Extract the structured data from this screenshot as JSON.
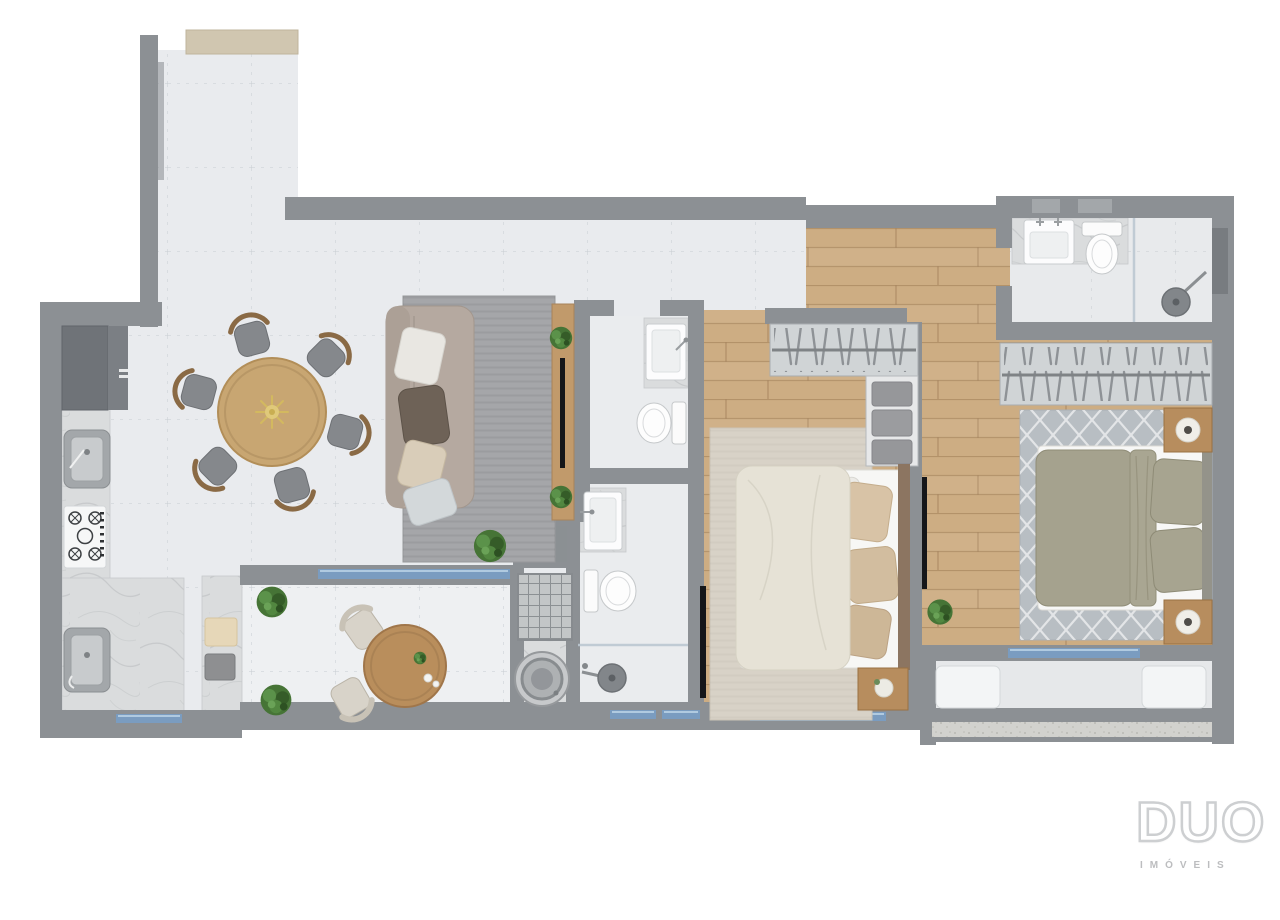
{
  "meta": {
    "title": "Apartment floor plan — top-down render"
  },
  "logo": {
    "title": "DUO",
    "subtitle": "IMÓVEIS"
  },
  "palette": {
    "background": "#ffffff",
    "wall": "#8c9094",
    "tile_floor": "#e9ebee",
    "wood_floor": "#cdad83",
    "marble": "#dadcdd",
    "glass": "#7a9cc0",
    "rug_living": "#a5a6a9",
    "rug_bedroom1": "#d8d2c7",
    "rug_bedroom2": "#b8bec3",
    "sofa": "#b5a9a0",
    "dining_table_wood": "#c8a672",
    "balcony_table_wood": "#b98e5c",
    "blanket_cream": "#e6e2d6",
    "blanket_olive": "#a5a28e",
    "nightstand_wood": "#b78d5e",
    "fixture_white": "#f9fafa",
    "plant_green": "#467436",
    "tv_black": "#151619",
    "logo_gray": "#cdcfd1"
  },
  "plan": {
    "rooms": [
      {
        "id": "entry-hall",
        "furniture": [
          "entry-door-sill"
        ]
      },
      {
        "id": "kitchen",
        "furniture": [
          "refrigerator-cabinet",
          "marble-counter",
          "steel-sink",
          "cooktop"
        ]
      },
      {
        "id": "dining-area",
        "furniture": [
          "round-dining-table",
          "dining-chairs-x6",
          "gold-centerpiece"
        ]
      },
      {
        "id": "living-room",
        "furniture": [
          "sofa",
          "pillows-x4",
          "area-rug",
          "tv-panel",
          "wall-tv",
          "plants"
        ]
      },
      {
        "id": "balcony",
        "furniture": [
          "bistro-table",
          "balcony-chairs-x2",
          "potted-plants-x2",
          "towel-counter",
          "sliding-glass-door"
        ]
      },
      {
        "id": "laundry-area",
        "furniture": [
          "laundry-sink",
          "washing-machine",
          "towels",
          "vent-grate"
        ]
      },
      {
        "id": "bathroom-1",
        "furniture": [
          "vanity-sink",
          "toilet"
        ]
      },
      {
        "id": "bathroom-2",
        "furniture": [
          "vanity-sink",
          "toilet",
          "rain-shower"
        ]
      },
      {
        "id": "hallway",
        "furniture": []
      },
      {
        "id": "bedroom-1",
        "furniture": [
          "double-bed",
          "cream-blanket",
          "pillows",
          "wardrobe-hangers",
          "shelf-clothes",
          "nightstand",
          "area-rug",
          "wall-tv"
        ]
      },
      {
        "id": "bedroom-2",
        "furniture": [
          "double-bed",
          "olive-blanket",
          "pillows-x2",
          "wardrobe-hangers",
          "nightstands-x2",
          "round-lamps-x2",
          "lattice-rug",
          "wall-tv",
          "floor-plant"
        ]
      },
      {
        "id": "suite-bathroom",
        "furniture": [
          "counter-sink",
          "toilet",
          "rain-shower",
          "glass-partition"
        ]
      },
      {
        "id": "rear-balcony",
        "furniture": [
          "bench-x2",
          "sliding-glass-door"
        ]
      }
    ]
  }
}
